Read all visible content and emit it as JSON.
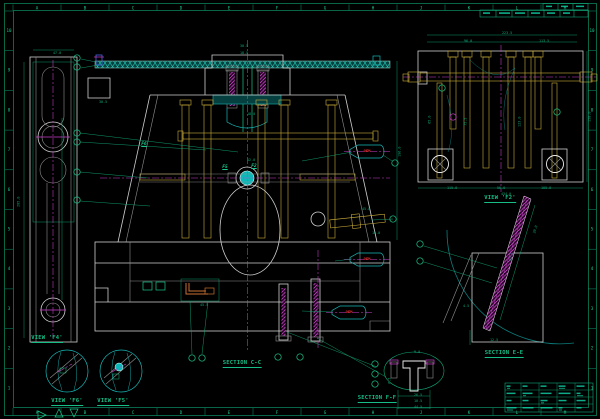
{
  "drawing": {
    "type": "mold-assembly-cad-drawing",
    "background": "#000000"
  },
  "labels": {
    "view_f2": "VIEW 'F2'",
    "view_f4": "VIEW 'F4'",
    "view_f5": "VIEW 'F5'",
    "view_f6": "VIEW 'F6'",
    "section_cc": "SECTION C-C",
    "section_ee": "SECTION E-E",
    "section_ff": "SECTION F-F"
  },
  "flags": [
    {
      "text": "F6",
      "x": 144,
      "y": 143
    },
    {
      "text": "F5",
      "x": 225,
      "y": 166
    },
    {
      "text": "F2",
      "x": 254,
      "y": 165
    }
  ],
  "callouts": [
    {
      "text": "OEM",
      "x": 367,
      "y": 149
    },
    {
      "text": "OEM",
      "x": 367,
      "y": 257
    },
    {
      "text": "OEM",
      "x": 349,
      "y": 310
    }
  ],
  "ruler": {
    "letters": [
      "A",
      "B",
      "C",
      "D",
      "E",
      "F",
      "G",
      "H",
      "J",
      "K",
      "L",
      "M"
    ],
    "numbers": [
      "10",
      "9",
      "8",
      "7",
      "6",
      "5",
      "4",
      "3",
      "2",
      "1"
    ]
  },
  "colors": {
    "green": "#0fa878",
    "bright_green": "#19c98c",
    "cyan": "#17b8b8",
    "white": "#cfcfcf",
    "gold": "#c9ab3a",
    "magenta": "#cc3ecc",
    "blue": "#4a63e8",
    "red": "#d92b2b",
    "orange": "#c87030"
  },
  "dims": [
    {
      "t": "30.5",
      "x": 240,
      "y": 45
    },
    {
      "t": "18.5",
      "x": 240,
      "y": 52
    },
    {
      "t": "30.5",
      "x": 99,
      "y": 101
    },
    {
      "t": "47.0",
      "x": 53,
      "y": 52
    },
    {
      "t": "285.0",
      "x": 19,
      "y": 200,
      "r": -90
    },
    {
      "t": "196.0",
      "x": 400,
      "y": 150,
      "r": -90
    },
    {
      "t": "45.0",
      "x": 362,
      "y": 208
    },
    {
      "t": "16.0",
      "x": 372,
      "y": 232
    },
    {
      "t": "45.5",
      "x": 200,
      "y": 304
    },
    {
      "t": "12.0",
      "x": 247,
      "y": 159
    },
    {
      "t": "18.0",
      "x": 247,
      "y": 113
    },
    {
      "t": "223.5",
      "x": 502,
      "y": 32
    },
    {
      "t": "96.0",
      "x": 464,
      "y": 40
    },
    {
      "t": "113.5",
      "x": 539,
      "y": 40
    },
    {
      "t": "115.0",
      "x": 447,
      "y": 187
    },
    {
      "t": "56.0",
      "x": 497,
      "y": 187
    },
    {
      "t": "105.0",
      "x": 541,
      "y": 187
    },
    {
      "t": "434.0",
      "x": 501,
      "y": 193
    },
    {
      "t": "158.0",
      "x": 590,
      "y": 115,
      "r": -90
    },
    {
      "t": "123.0",
      "x": 520,
      "y": 120,
      "r": -90
    },
    {
      "t": "75.5",
      "x": 466,
      "y": 120,
      "r": -90
    },
    {
      "t": "65.0",
      "x": 430,
      "y": 118,
      "r": -90
    },
    {
      "t": "82.5",
      "x": 512,
      "y": 255,
      "r": -73
    },
    {
      "t": "30.0",
      "x": 536,
      "y": 228,
      "r": -73
    },
    {
      "t": "12.5",
      "x": 490,
      "y": 339
    },
    {
      "t": "4.5",
      "x": 463,
      "y": 305
    },
    {
      "t": "9.0",
      "x": 414,
      "y": 351
    },
    {
      "t": "26.5",
      "x": 414,
      "y": 394
    },
    {
      "t": "10.5",
      "x": 414,
      "y": 400
    },
    {
      "t": "44.5",
      "x": 414,
      "y": 406
    },
    {
      "t": "6.5",
      "x": 390,
      "y": 379,
      "r": -90
    }
  ],
  "balloons": [
    {
      "x": 77,
      "y": 58,
      "k": "g"
    },
    {
      "x": 77,
      "y": 67,
      "k": "g"
    },
    {
      "x": 77,
      "y": 133,
      "k": "g"
    },
    {
      "x": 77,
      "y": 142,
      "k": "g"
    },
    {
      "x": 77,
      "y": 172,
      "k": "g"
    },
    {
      "x": 77,
      "y": 200,
      "k": "g"
    },
    {
      "x": 395,
      "y": 163,
      "k": "g"
    },
    {
      "x": 393,
      "y": 219,
      "k": "g"
    },
    {
      "x": 192,
      "y": 358,
      "k": "g"
    },
    {
      "x": 202,
      "y": 358,
      "k": "g"
    },
    {
      "x": 278,
      "y": 357,
      "k": "g"
    },
    {
      "x": 300,
      "y": 357,
      "k": "g"
    },
    {
      "x": 420,
      "y": 244,
      "k": "g"
    },
    {
      "x": 420,
      "y": 261,
      "k": "g"
    },
    {
      "x": 375,
      "y": 364,
      "k": "g"
    },
    {
      "x": 375,
      "y": 374,
      "k": "g"
    },
    {
      "x": 375,
      "y": 384,
      "k": "g"
    },
    {
      "x": 442,
      "y": 88,
      "k": "b"
    },
    {
      "x": 557,
      "y": 112,
      "k": "b"
    },
    {
      "x": 453,
      "y": 117,
      "k": "m"
    }
  ],
  "leaders": [
    [
      81,
      59,
      96,
      62
    ],
    [
      81,
      68,
      98,
      65
    ],
    [
      80,
      133,
      238,
      152
    ],
    [
      80,
      142,
      206,
      150
    ],
    [
      80,
      172,
      148,
      178
    ],
    [
      80,
      201,
      150,
      206
    ],
    [
      352,
      152,
      302,
      161
    ],
    [
      383,
      155,
      392,
      161
    ],
    [
      352,
      259,
      335,
      261
    ],
    [
      332,
      312,
      302,
      311
    ],
    [
      424,
      246,
      497,
      268
    ],
    [
      424,
      262,
      492,
      283
    ],
    [
      287,
      332,
      377,
      367
    ],
    [
      317,
      338,
      386,
      377
    ],
    [
      190,
      301,
      192,
      354
    ],
    [
      208,
      301,
      202,
      354
    ],
    [
      393,
      219,
      372,
      220
    ]
  ]
}
